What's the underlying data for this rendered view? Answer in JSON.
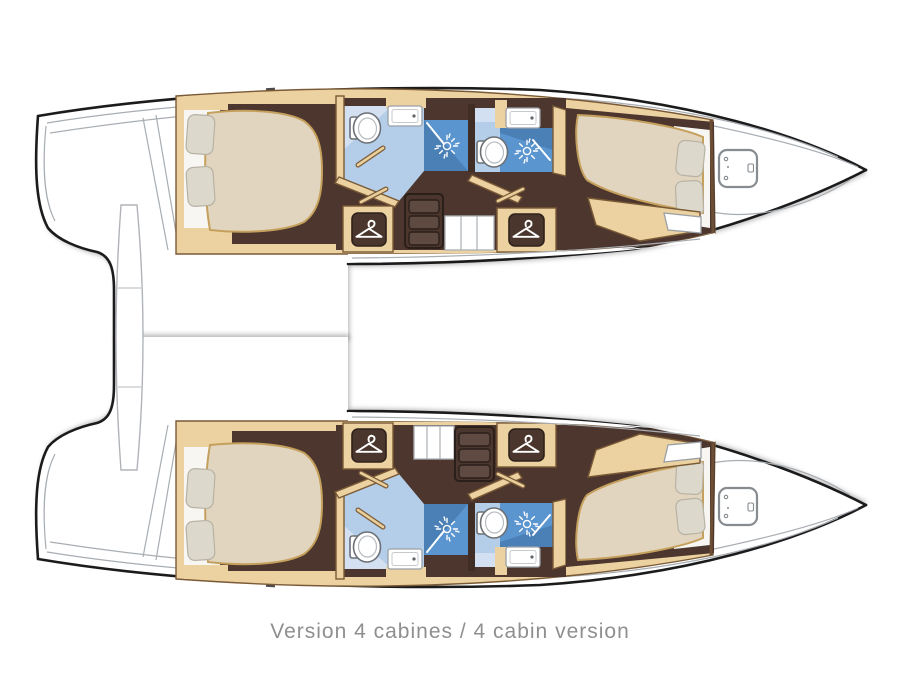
{
  "caption": {
    "text": "Version 4 cabines / 4 cabin version"
  },
  "palette": {
    "hull_outline": "#1b1b1b",
    "deck_line": "#a8adb2",
    "wood_trim": "#7a5a36",
    "cabinet_tan": "#ecd2a0",
    "floor_brown": "#4c362e",
    "bath_floor_blue": "#b4cee9",
    "bath_floor_light": "#d2e0f2",
    "shower_blue": "#5b95cf",
    "shower_blue_dark": "#4a80b6",
    "mattress_beige": "#e2d5bf",
    "mattress_edge": "#c4a05c",
    "pillow_gray": "#dcd8cc",
    "caption_gray": "#8f8f8f"
  },
  "boat": {
    "type": "catamaran deck plan, hull level, bows pointing right",
    "version_label": "Version 4 cabines / 4 cabin version",
    "hulls": [
      {
        "name": "top hull",
        "rooms": [
          {
            "name": "aft cabin",
            "features": [
              "double bed",
              "2 pillows",
              "wardrobe with hanger icon"
            ]
          },
          {
            "name": "aft bathroom",
            "fixtures": [
              "toilet",
              "sink",
              "shower with sun icon"
            ]
          },
          {
            "name": "companionway",
            "features": [
              "3-step stairs",
              "storage lockers"
            ]
          },
          {
            "name": "forward bathroom",
            "fixtures": [
              "toilet",
              "sink",
              "shower with sun icon"
            ]
          },
          {
            "name": "forward cabin",
            "features": [
              "double bed",
              "2 pillows",
              "wardrobe with hanger icon"
            ]
          },
          {
            "name": "forepeak",
            "features": [
              "deck hatch"
            ]
          }
        ]
      },
      {
        "name": "bottom hull",
        "rooms": [
          {
            "name": "aft cabin",
            "features": [
              "double bed",
              "2 pillows",
              "wardrobe with hanger icon"
            ]
          },
          {
            "name": "aft bathroom",
            "fixtures": [
              "toilet",
              "sink",
              "shower with sun icon"
            ]
          },
          {
            "name": "companionway",
            "features": [
              "3-step stairs",
              "storage lockers"
            ]
          },
          {
            "name": "forward bathroom",
            "fixtures": [
              "toilet",
              "sink",
              "shower with sun icon"
            ]
          },
          {
            "name": "forward cabin",
            "features": [
              "double bed",
              "2 pillows",
              "wardrobe with hanger icon"
            ]
          },
          {
            "name": "forepeak",
            "features": [
              "deck hatch"
            ]
          }
        ]
      }
    ],
    "icons": [
      {
        "name": "hanger-icon",
        "meaning": "wardrobe / closet"
      },
      {
        "name": "sun-icon",
        "meaning": "shower"
      },
      {
        "name": "toilet-icon",
        "meaning": "marine toilet"
      },
      {
        "name": "sink-icon",
        "meaning": "washbasin"
      },
      {
        "name": "hatch-icon",
        "meaning": "bow deck hatch"
      }
    ]
  }
}
